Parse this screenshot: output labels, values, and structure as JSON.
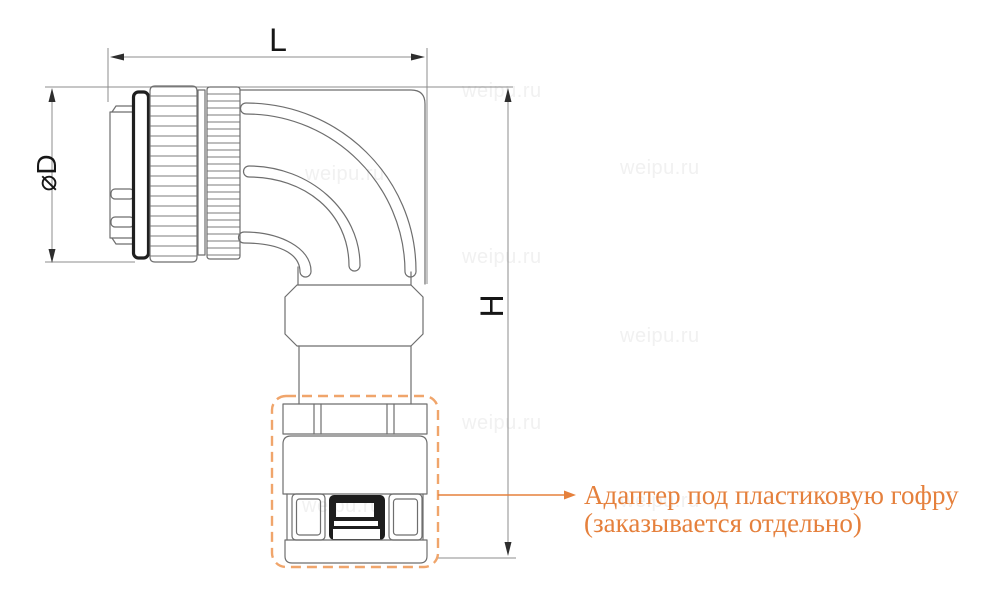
{
  "drawing": {
    "dimension_labels": {
      "length_label": "L",
      "height_label": "H",
      "diameter_label": "⌀D"
    },
    "callout": {
      "line1": "Адаптер под пластиковую гофру",
      "line2": "(заказывается отдельно)"
    },
    "watermark_text": "weipu.ru",
    "colors": {
      "line_art": "#6e6e6e",
      "dark_detail": "#1d1d1d",
      "dimension_text": "#161616",
      "callout_orange": "#e5803c",
      "dashed_box_orange": "#f0a56b",
      "watermark_gray": "#f1f1f1",
      "background": "#ffffff"
    }
  }
}
